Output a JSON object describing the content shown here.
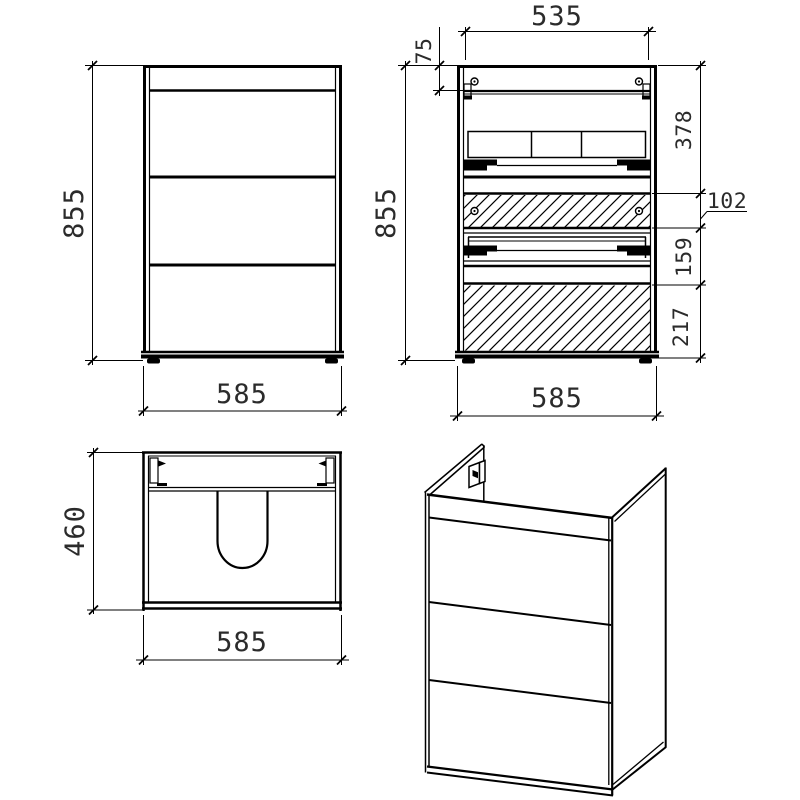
{
  "drawing": {
    "background": "#ffffff",
    "line_color": "#000000",
    "text_color": "#2b2b2b",
    "views": {
      "front": {
        "height_label": "855",
        "width_label": "585"
      },
      "section": {
        "top_inner_width_label": "535",
        "hanger_offset_label": "75",
        "height_label": "855",
        "upper_compartment_label": "378",
        "upper_drawer_front_label": "102",
        "middle_compartment_label": "159",
        "lower_drawer_front_label": "217",
        "width_label": "585"
      },
      "plan": {
        "depth_label": "460",
        "width_label": "585"
      }
    }
  }
}
